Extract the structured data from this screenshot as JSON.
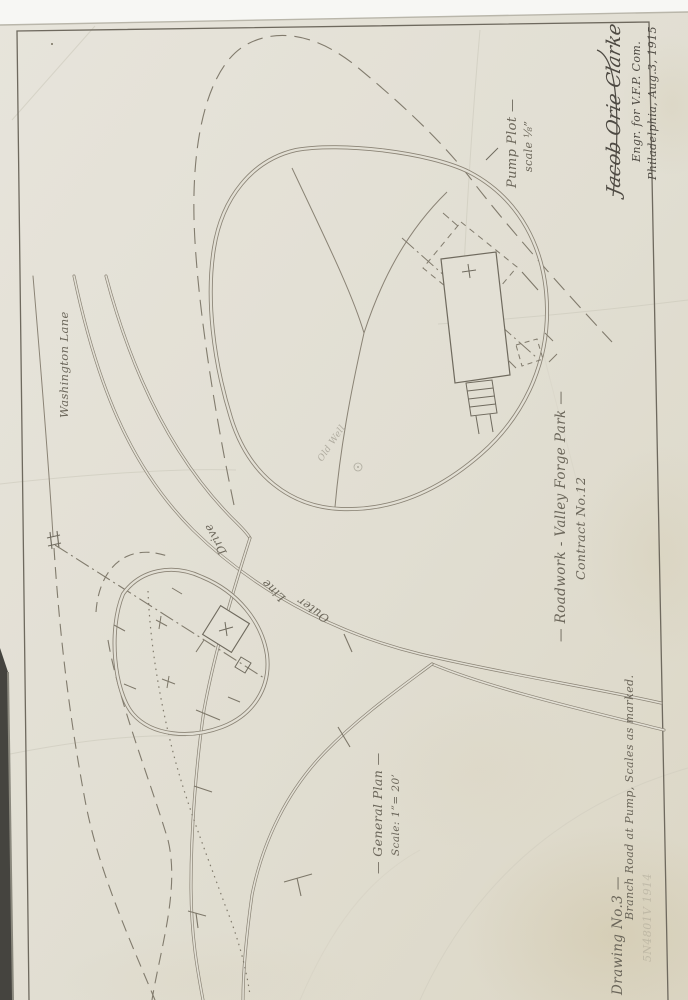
{
  "sheet": {
    "labels": {
      "washington_lane": "Washington Lane",
      "road_words": [
        "Outer",
        "Line",
        "Drive"
      ],
      "pump_plot_title": "Pump Plot —",
      "pump_plot_scale": "scale ⅛”",
      "project_title": "— Roadwork - Valley Forge Park —",
      "contract": "Contract No.12",
      "general_plan_title": "— General Plan —",
      "general_plan_scale": "Scale: 1”= 20’",
      "drawing_no": "Drawing No.3 —",
      "drawing_subtitle": "Branch Road at Pump, Scales as marked.",
      "well_note": "Old Well",
      "faint_mark": "5N4801V 1914"
    },
    "signature": {
      "name": "Jacob Orie Clarke",
      "title": "Engr. for V.F.P. Com.",
      "place_date": "Philadelphia, Aug.3, 1915"
    },
    "colors": {
      "paper": "#e3e0d5",
      "ink": "#8a8375",
      "ink_dark": "#6f6a5e",
      "scan_background": "#f7f7f4",
      "scan_edge_dark": "#45443f",
      "stain": "#c8b98e"
    }
  }
}
